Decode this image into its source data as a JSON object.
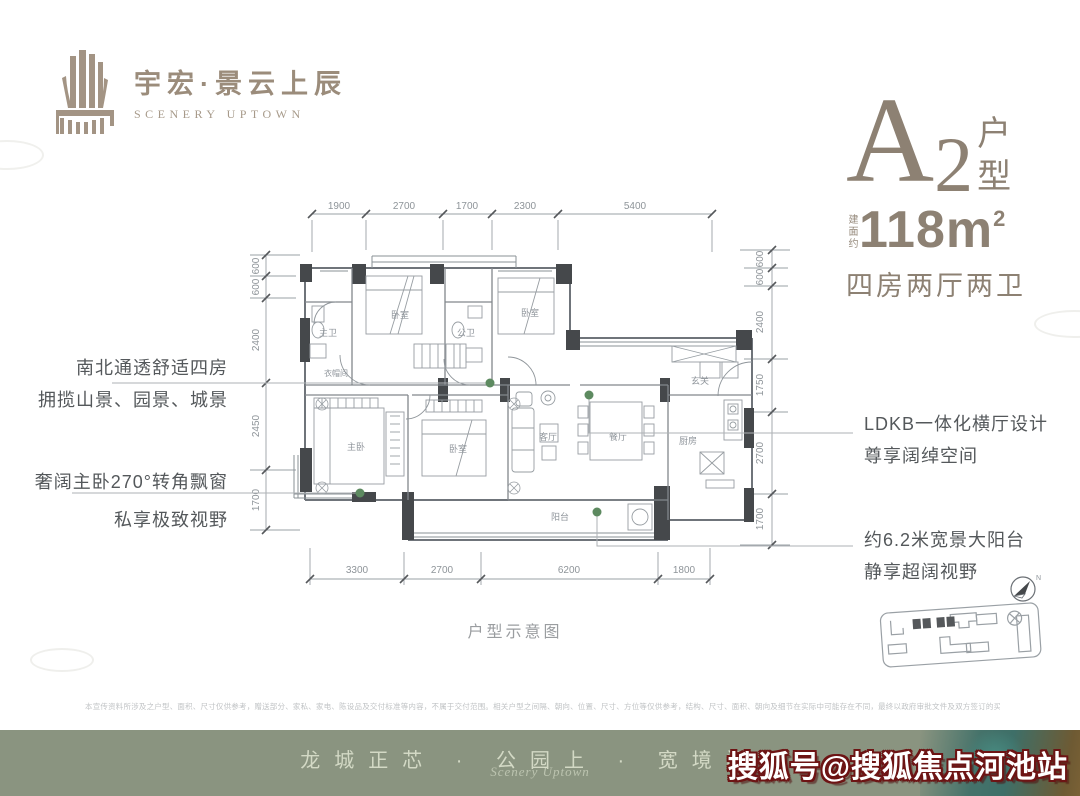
{
  "brand": {
    "name_cn": "宇宏·景云上辰",
    "name_en": "SCENERY UPTOWN"
  },
  "unit": {
    "letter": "A",
    "number": "2",
    "suffix_stacked": [
      "户",
      "型"
    ],
    "area_prefix": "建面约",
    "area_value": "118m",
    "area_sup": "2",
    "layout": "四房两厅两卫"
  },
  "annotations": {
    "left_top": [
      "南北通透舒适四房",
      "拥揽山景、园景、城景"
    ],
    "left_bottom": [
      "奢阔主卧270°转角飘窗",
      "私享极致视野"
    ],
    "right_top": [
      "LDKB一体化横厅设计",
      "尊享阔绰空间"
    ],
    "right_bottom": [
      "约6.2米宽景大阳台",
      "静享超阔视野"
    ]
  },
  "plan": {
    "caption": "户型示意图",
    "dims_top": [
      "1900",
      "2700",
      "1700",
      "2300",
      "5400"
    ],
    "dims_bottom": [
      "3300",
      "2700",
      "6200",
      "1800"
    ],
    "dims_left": [
      "600",
      "600",
      "2400",
      "2450",
      "1700"
    ],
    "dims_right": [
      "600",
      "600",
      "2400",
      "1750",
      "2700",
      "1700"
    ],
    "rooms": {
      "bedroom_top": "卧室",
      "master_bath": "主卫",
      "public_bath": "公卫",
      "bedroom_top_right": "卧室",
      "entry": "玄关",
      "cloak": "衣帽间",
      "master_bedroom": "主卧",
      "bedroom_mid": "卧室",
      "living": "客厅",
      "dining": "餐厅",
      "kitchen": "厨房",
      "balcony": "阳台"
    },
    "compass_label": "N"
  },
  "disclaimer": "本宣传资料所涉及之户型、面积、尺寸仅供参考，赠送部分、家私、家电、陈设品及交付标准等内容，不属于交付范围。相关户型之间隔、朝向、位置、尺寸、方位等仅供参考，结构、尺寸、面积、朝向及细节在实际中可能存在不同，最终以政府审批文件及双方签订的买卖合同及附件为准。本公司保留对宣传资料修改之权利，敬请留意最新资料。",
  "footer": {
    "slogan": "龙城正芯 · 公园上 · 宽境阔邸",
    "script": "Scenery Uptown",
    "watermark": "搜狐号@搜狐焦点河池站"
  },
  "colors": {
    "brand_taupe": "#9b8c7b",
    "unit_taupe": "#8d8173",
    "wall_dark": "#45484b",
    "plan_line": "#80868b",
    "accent_dot": "#5d8a60",
    "footer_green": "#8a9480",
    "watermark_outline": "#6d1414"
  }
}
